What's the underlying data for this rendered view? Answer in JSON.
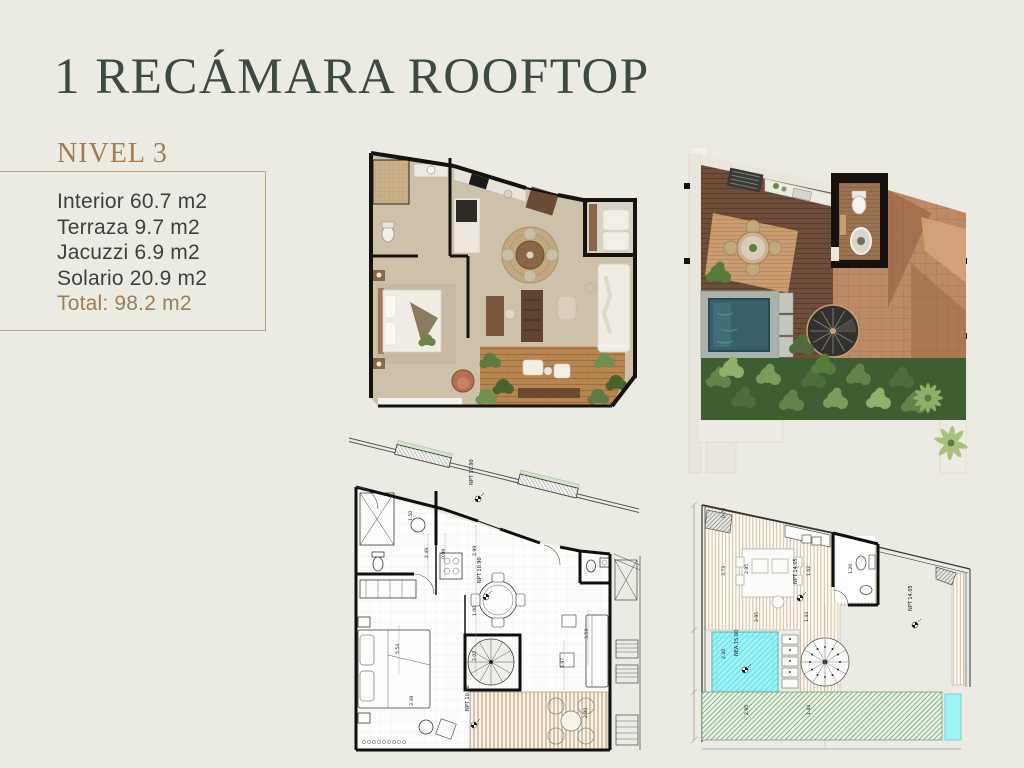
{
  "page": {
    "title": "1 RECÁMARA ROOFTOP",
    "bg_color": "#EBEBE4",
    "title_color": "#3D4A41"
  },
  "sidebar": {
    "level_label": "NIVEL 3",
    "accent_color": "#A17C4F",
    "box_border_color": "#C2A17C",
    "specs": {
      "items": [
        "Interior 60.7 m2",
        "Terraza 9.7 m2",
        "Jacuzzi 6.9 m2",
        "Solario 20.9 m2"
      ],
      "total": "Total: 98.2 m2"
    }
  },
  "plans": {
    "blueprint_interior": {
      "labels": {
        "npt_top": "NPT 10.90",
        "npt_center": "NPT 10.90",
        "npt_deck": "NPT 10.80"
      },
      "dims": [
        "2.49",
        "0.99",
        "1.50",
        "2.99",
        "1.00",
        "5.54",
        "3.39",
        "2.02",
        "2.97",
        "3.53",
        "2.00"
      ]
    },
    "blueprint_rooftop": {
      "labels": {
        "npt_deck": "NPT 14.05",
        "npt_solario": "NPT 14.05",
        "nea": "NEA 15.00"
      },
      "dims": [
        "0.73",
        "3.73",
        "2.95",
        "1.62",
        "1.26",
        "2.95",
        "1.44",
        "2.20",
        "2.95",
        "1.44"
      ]
    }
  }
}
